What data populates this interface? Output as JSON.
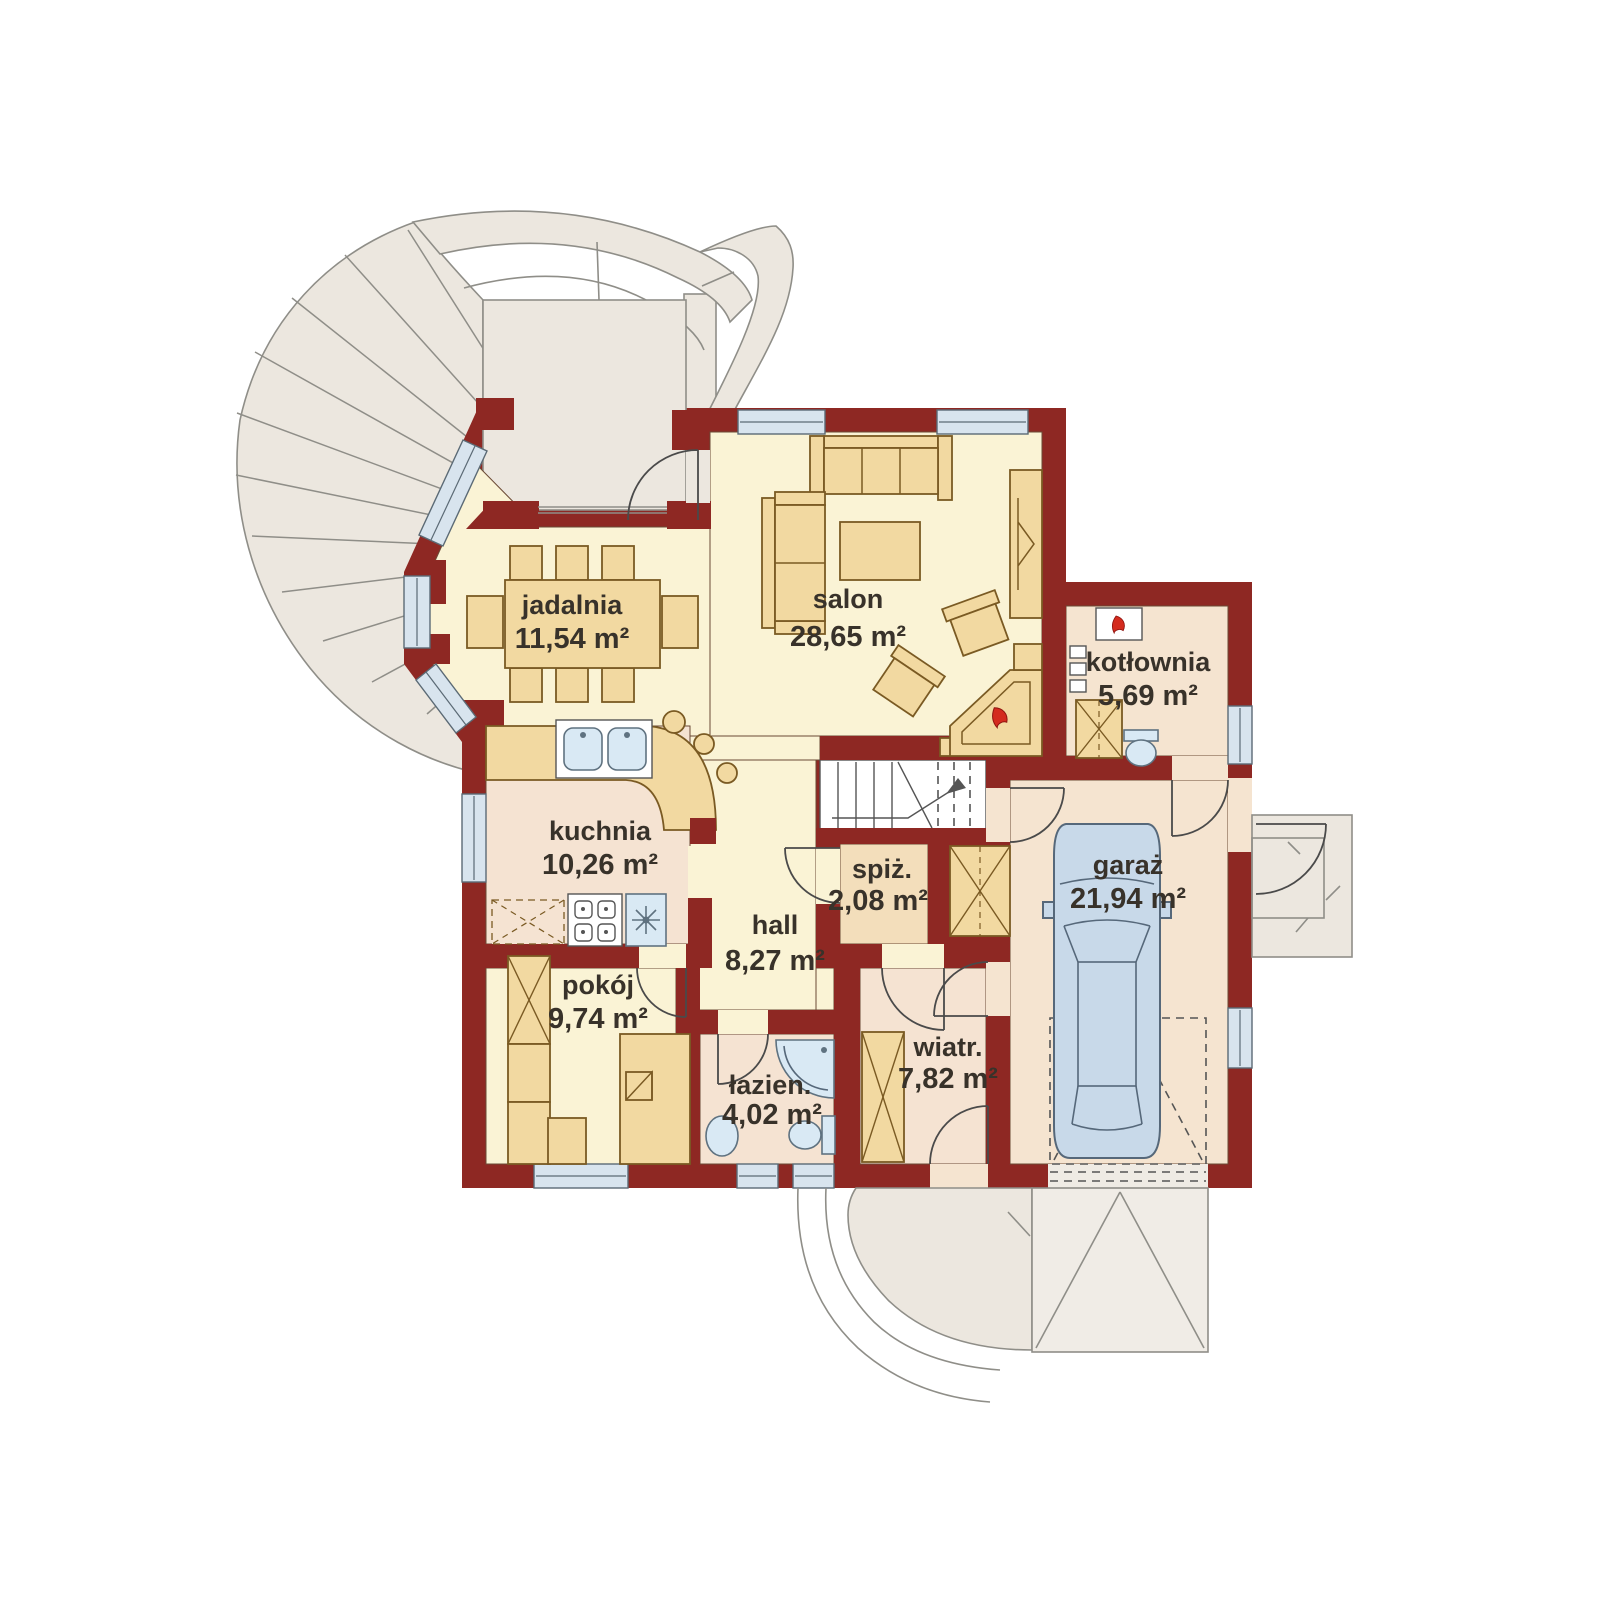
{
  "plan": {
    "type": "floor-plan",
    "language": "pl",
    "rooms": [
      {
        "id": "jadalnia",
        "name": "jadalnia",
        "area": "11,54 m²"
      },
      {
        "id": "salon",
        "name": "salon",
        "area": "28,65 m²"
      },
      {
        "id": "kotlownia",
        "name": "kotłownia",
        "area": "5,69 m²"
      },
      {
        "id": "kuchnia",
        "name": "kuchnia",
        "area": "10,26 m²"
      },
      {
        "id": "spiz",
        "name": "spiż.",
        "area": "2,08 m²"
      },
      {
        "id": "hall",
        "name": "hall",
        "area": "8,27 m²"
      },
      {
        "id": "garaz",
        "name": "garaż",
        "area": "21,94 m²"
      },
      {
        "id": "pokoj",
        "name": "pokój",
        "area": "9,74 m²"
      },
      {
        "id": "lazienka",
        "name": "łazien.",
        "area": "4,02 m²"
      },
      {
        "id": "wiatrolap",
        "name": "wiatr.",
        "area": "7,82 m²"
      }
    ],
    "colors": {
      "wall": "#8e2823",
      "room_cream": "#faf3d5",
      "room_pink": "#f5e3d2",
      "room_peach": "#f5e4d0",
      "room_tan": "#f3debb",
      "furniture": "#f2d9a1",
      "terrace": "#ece7df",
      "window": "#d8e4ee",
      "fixture": "#d9e9f4",
      "car": "#c8d9e9",
      "flame": "#d42b1e",
      "text": "#38322a"
    }
  }
}
